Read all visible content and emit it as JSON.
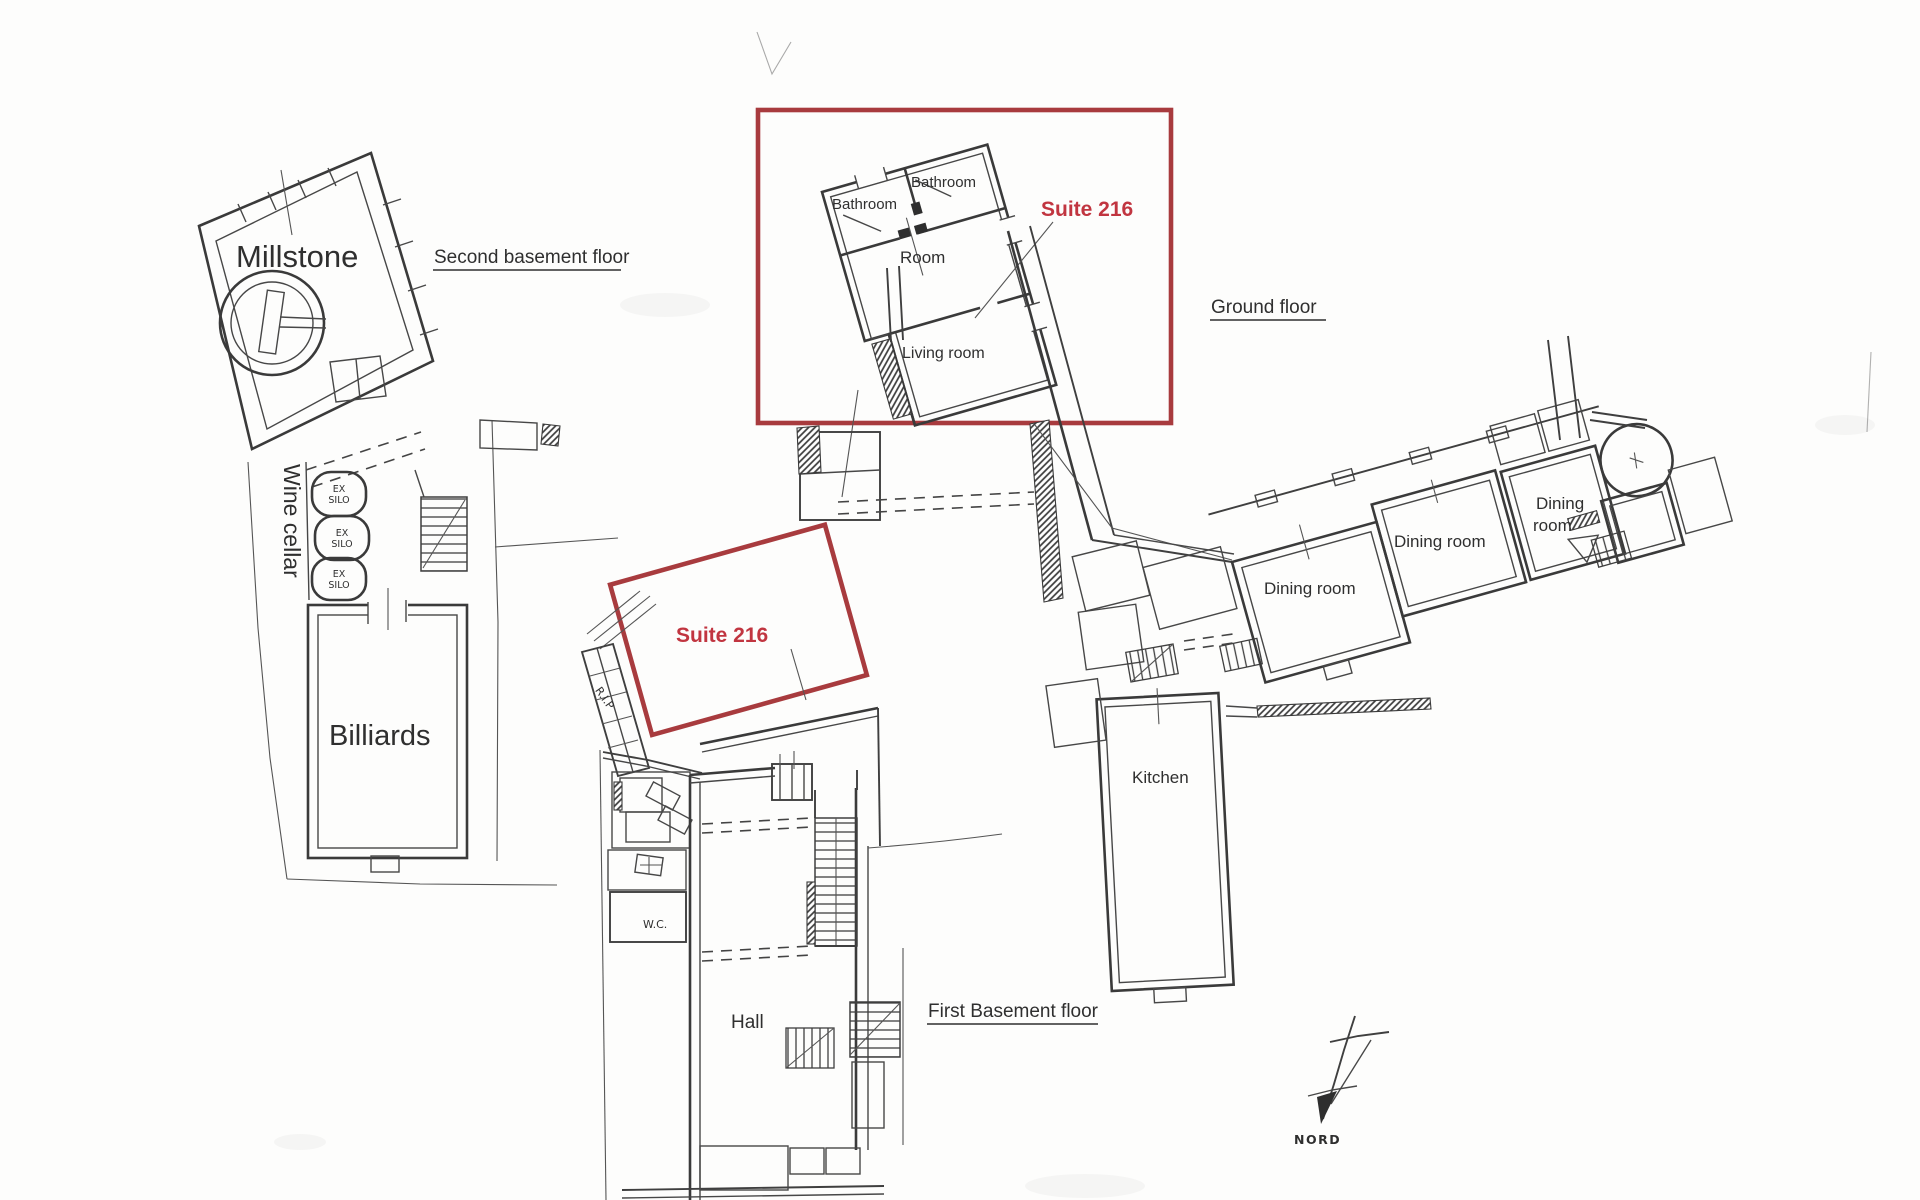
{
  "document": {
    "type": "scanned-floor-plan",
    "highlight_color": "#a83b3e",
    "suite_text_color": "#c13540",
    "ink_color": "#3a3a3a"
  },
  "floors": {
    "second_basement": {
      "title": "Second basement floor",
      "millstone": "Millstone",
      "wine_cellar": "Wine cellar",
      "billiards": "Billiards",
      "barrel_label": {
        "line1": "EX",
        "line2": "SILO"
      }
    },
    "ground": {
      "title": "Ground floor",
      "suite": {
        "name": "Suite 216",
        "bathroom_left": "Bathroom",
        "bathroom_right": "Bathroom",
        "room": "Room",
        "living_room": "Living room"
      },
      "dining_room_1": "Dining room",
      "dining_room_2": "Dining room",
      "dining_room_3": {
        "line1": "Dining",
        "line2": "room"
      },
      "kitchen": "Kitchen"
    },
    "first_basement": {
      "title": "First Basement floor",
      "suite_name": "Suite 216",
      "hall": "Hall",
      "wc": "W.C.",
      "rip": "R.I.P"
    }
  },
  "compass": {
    "north_label": "NORD"
  }
}
